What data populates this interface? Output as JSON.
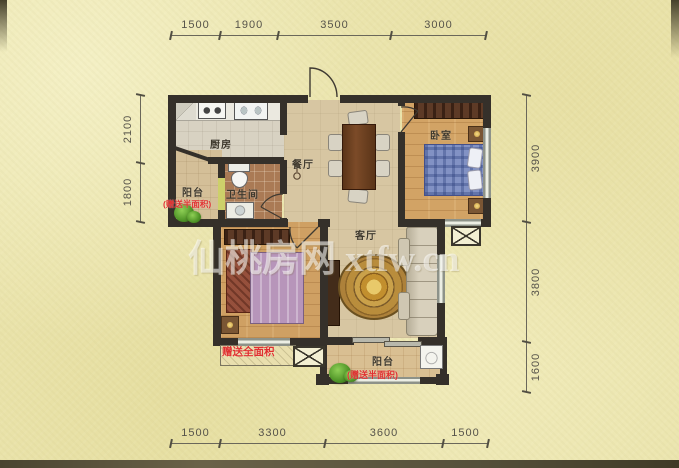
{
  "watermark": {
    "text": "仙桃房网 xtfw.cn"
  },
  "dims": {
    "top": [
      "1500",
      "1900",
      "3500",
      "3000"
    ],
    "bottom": [
      "1500",
      "3300",
      "3600",
      "1500"
    ],
    "left": [
      "2100",
      "1800"
    ],
    "right": [
      "3900",
      "3800",
      "1600"
    ]
  },
  "rooms": {
    "kitchen": {
      "label": "厨房"
    },
    "dining": {
      "label": "餐厅"
    },
    "bedroom_right": {
      "label": "卧室"
    },
    "bathroom": {
      "label": "卫生间"
    },
    "living": {
      "label": "客厅"
    },
    "balcony_left": {
      "label": "阳台",
      "note": "(赠送半面积)"
    },
    "balcony_bottom": {
      "label": "阳台",
      "note": "(赠送半面积)"
    },
    "bedroom_left": {
      "gift_note": "赠送全面积"
    }
  },
  "colors": {
    "background": "#ebe5ae",
    "wall": "#35302a",
    "accent_red": "#e03030",
    "wood_floor": "#d2a365",
    "rug_gold": "#c2912f"
  }
}
